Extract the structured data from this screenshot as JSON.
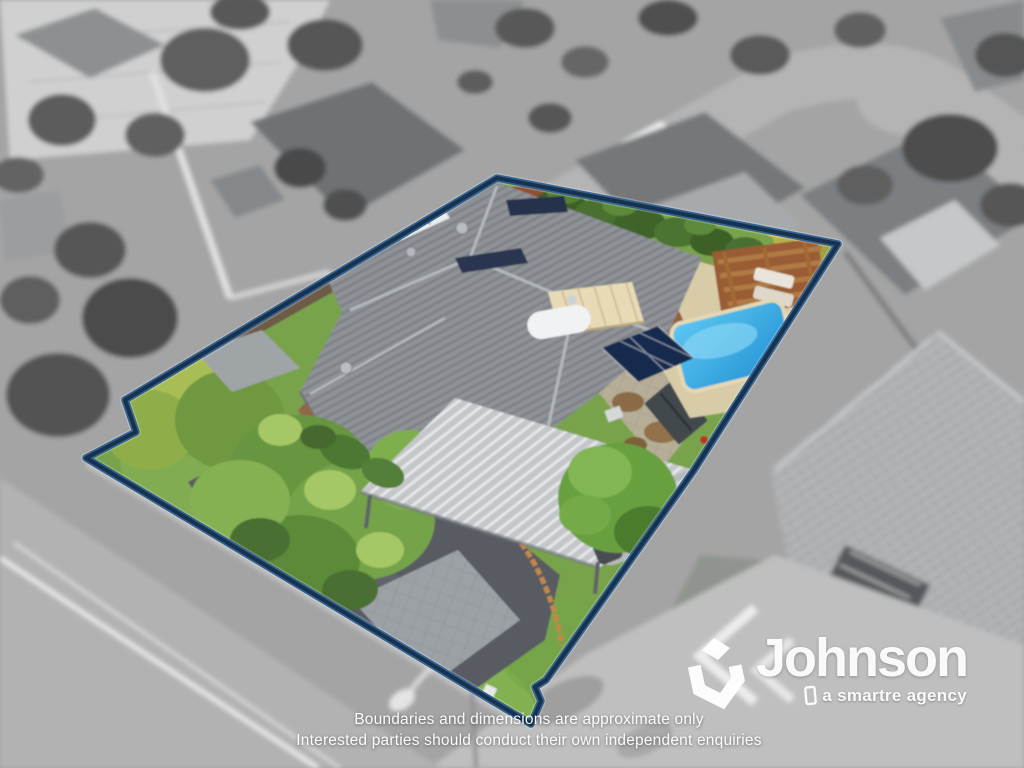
{
  "branding": {
    "name": "Johnson",
    "tagline": "a smartre agency",
    "text_color": "#ffffff"
  },
  "disclaimer": {
    "line1": "Boundaries and dimensions are approximate only",
    "line2": "Interested parties should conduct their own independent enquiries"
  },
  "colors": {
    "boundary_line": "#1c3b5e",
    "pool_water": "#2fa9e4",
    "lawn_green": "#79a34b",
    "house_roof_gray": "#8f9397"
  }
}
